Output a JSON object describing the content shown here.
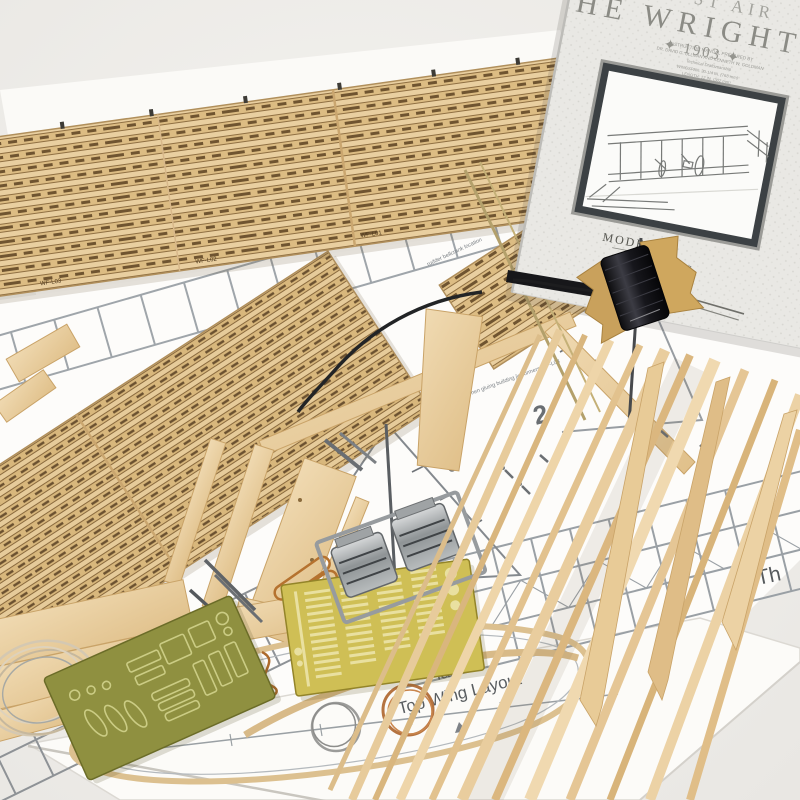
{
  "manual": {
    "banner_fragment": "ST AIR",
    "title_fragment": "HE WRIGHT",
    "year_line": "✦ 1903 ✦",
    "credits": [
      "INSTRUCTION MANUAL PREPARED BY",
      "DR. DAVID G. ULLMAN AND KENNETH W. GOLDMAN",
      "Technical Draftsmanship",
      "WINGSPAN: 30-1/4 IN. (768 mm)",
      "LENGTH: 12 IN. (302 mm)"
    ],
    "brand_word1": "MODEL",
    "brand_word2": "AIRWAYS"
  },
  "plans": {
    "plan1_title": "Plan 1",
    "plan1_subtitle": "Top Wing Layout",
    "plan2_title": "Plan 2",
    "plan2_subtitle": "Bottom Wing L",
    "plan2_number": "2",
    "right_fragment": "Th",
    "tick_label": "3",
    "annotations": {
      "bellcrank": "rudder bellcrank location",
      "formers": "when gluing building jig formers WF-L04",
      "ribbar": "Rib reinforcing bar",
      "location": "ne location",
      "wings": "both wings",
      "left1": "ribs WF-P06",
      "left2": "spars, 18 to"
    }
  },
  "sheets": {
    "l01": "WF-L01",
    "l02": "WF-L02",
    "l03": "WF-L03",
    "l04": "WF-L04"
  },
  "colors": {
    "wood_sheet": "#e9cfa0",
    "wood_rib": "#dcbc83",
    "wood_strip": "#e7cb9b",
    "brass_fret": "#cfbf55",
    "olive_fret": "#8f9040",
    "copper_wire": "#b57340",
    "steel_wire": "#9b9b99",
    "thread_black": "#1d1d1f",
    "cast_metal": "#b9bcbd",
    "paper": "#fcfbf8",
    "plan_line": "#9aa0a5"
  }
}
